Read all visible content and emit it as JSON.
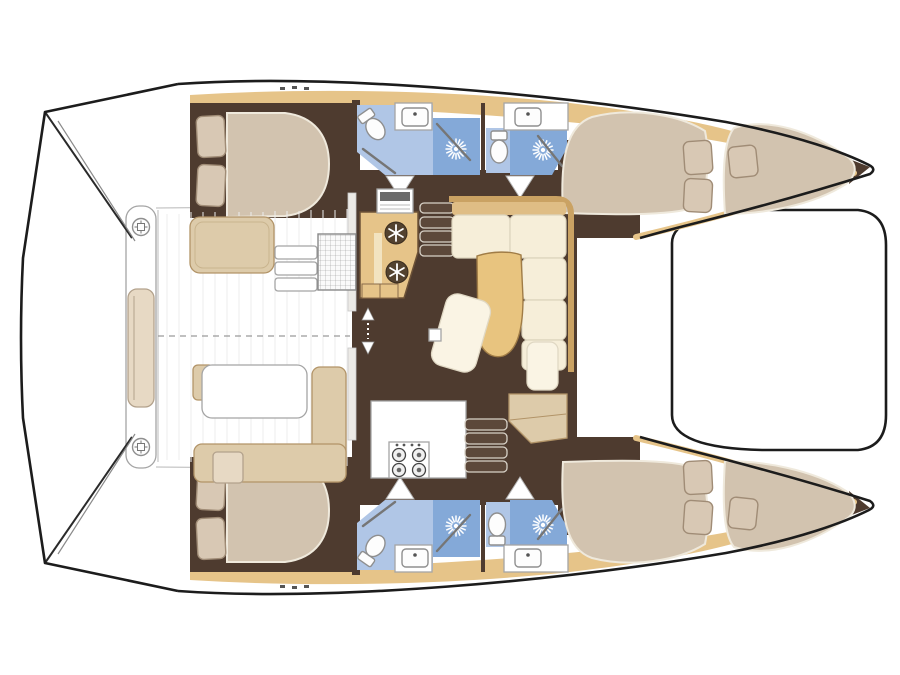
{
  "title": "Catamaran interior layout floor plan, bow to the right",
  "type": "boat-floor-plan",
  "colors": {
    "outline": "#1c1c1c",
    "deck": "#ffffff",
    "deckLine": "#c6c6c6",
    "gunwale": "#e6c489",
    "floorDark": "#4e3b2f",
    "bathBlue": "#b0c6e6",
    "showerBlue": "#84a9d8",
    "bed": "#d2c3af",
    "pillow": "#d8c8b4",
    "pillowStroke": "#a08c76",
    "sofa": "#f6eed9",
    "sofaBack": "#dfbd85",
    "wood": "#e8c47f",
    "benchTan": "#ddcbaa",
    "cushion": "#e7d9c4",
    "step": "#5c483a",
    "stepEdge": "#d8d2c8",
    "fixtureStroke": "#8f8f8f"
  },
  "vessel": {
    "style": "sailing-catamaran",
    "orientation": "bow-right",
    "hulls": [
      {
        "name": "port-hull",
        "rooms": [
          "aft-double-cabin",
          "aft-bathroom",
          "forward-bathroom",
          "forward-double-cabin",
          "forepeak-berth"
        ]
      },
      {
        "name": "starboard-hull",
        "rooms": [
          "aft-double-cabin",
          "aft-bathroom",
          "forward-bathroom",
          "forward-double-cabin",
          "forepeak-berth"
        ]
      }
    ],
    "saloon": {
      "features": [
        "aft-galley-counter",
        "double-fridge-drawers",
        "sink-unit",
        "l-shaped-sofa",
        "curved-cocktail-table",
        "chaise-seat",
        "forward-galley-counter",
        "four-burner-stove",
        "port-companionway-stairs",
        "starboard-companionway-stairs",
        "sliding-door"
      ]
    },
    "cockpit": {
      "features": [
        "bench-seat-aft-port",
        "l-shaped-bench",
        "cockpit-table",
        "deck-grate",
        "boarding-steps",
        "transom-bench",
        "round-cocktail-tables",
        "teak-planking"
      ]
    },
    "foredeck": {
      "features": [
        "trampoline-platform"
      ]
    },
    "stern": {
      "features": [
        "swim-platform",
        "transom-steps"
      ]
    },
    "counts": {
      "double_cabins": 4,
      "forepeak_berths": 2,
      "bathrooms": 4,
      "showers": 4,
      "toilets": 4,
      "sinks": 4,
      "fridge_drawers": 2,
      "stove_burners": 4,
      "round_cocktail_tables": 2
    },
    "icons": [
      "sunburst-shower-icon",
      "snowflake-fridge-icon",
      "toilet-icon",
      "sink-icon",
      "stove-burner-icon",
      "drink-table-icon",
      "sliding-door-arrow-icon"
    ]
  }
}
